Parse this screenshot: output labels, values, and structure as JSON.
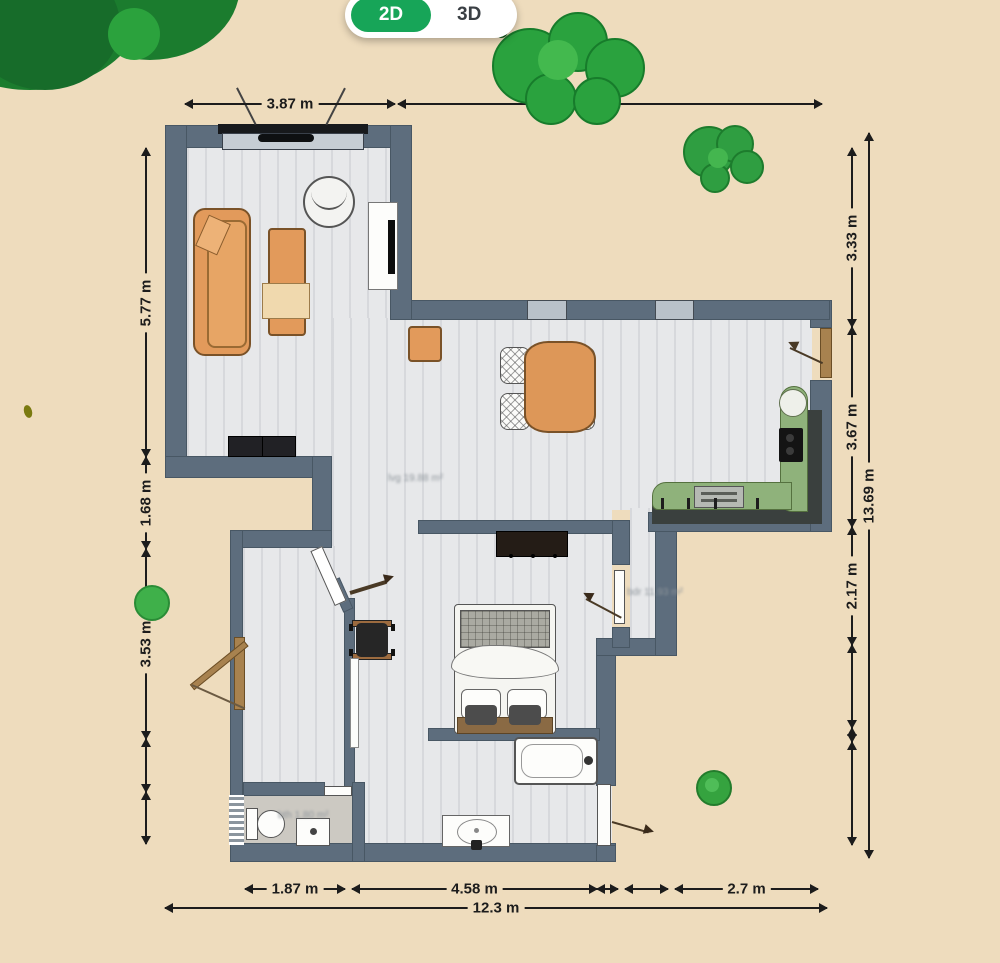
{
  "view_toggle": {
    "options": [
      {
        "label": "2D",
        "active": true
      },
      {
        "label": "3D",
        "active": false
      }
    ]
  },
  "dimensions": {
    "top": "3.87 m",
    "left": [
      "5.77 m",
      "1.68 m",
      "3.53 m"
    ],
    "right": [
      "3.33 m",
      "3.67 m",
      "2.17 m"
    ],
    "right_total": "13.69 m",
    "bottom": [
      "1.87 m",
      "4.58 m",
      "2.7 m"
    ],
    "bottom_total": "12.3 m"
  },
  "room_labels": [
    {
      "text": "lvg 19.88 m²"
    },
    {
      "text": "bdr 11.93 m²"
    },
    {
      "text": "bth 1.80 m²"
    }
  ],
  "colors": {
    "background": "#eedcbd",
    "wall": "#5d6d7d",
    "floor": "#e7e8ea",
    "accent_green": "#17a558",
    "furniture_orange": "#e29a5b",
    "kitchen_counter_green": "#8fb27b",
    "tree_green": "#2aa23e",
    "dimension_ink": "#1c1c1c"
  }
}
